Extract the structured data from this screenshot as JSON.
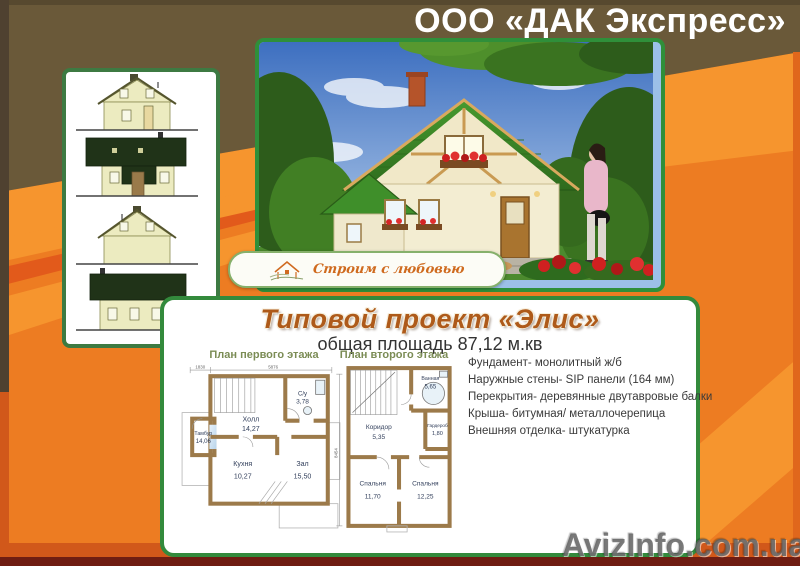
{
  "header": {
    "company": "ООО «ДАК Экспресс»"
  },
  "photo": {
    "slogan": "Строим с любовью"
  },
  "project": {
    "title": "Типовой проект «Элис»",
    "subtitle": "общая площадь 87,12 м.кв"
  },
  "plans": {
    "first": {
      "title": "План первого этажа",
      "dims": {
        "a": "1830",
        "b": "5876"
      },
      "rooms": [
        {
          "name": "Холл",
          "area": "14,27"
        },
        {
          "name": "С/у",
          "area": "3,78"
        },
        {
          "name": "Тамбур",
          "area": "14,06"
        },
        {
          "name": "Кухня",
          "area": "10,27"
        },
        {
          "name": "Зал",
          "area": "15,50"
        }
      ]
    },
    "second": {
      "title": "План второго этажа",
      "dims": {
        "v": "8454"
      },
      "rooms": [
        {
          "name": "Ванная",
          "area": "5,65"
        },
        {
          "name": "Коридор",
          "area": "5,35"
        },
        {
          "name": "Гардероб",
          "area": "1,80"
        },
        {
          "name": "Спальня",
          "area": "11,70"
        },
        {
          "name": "Спальня",
          "area": "12,25"
        }
      ]
    }
  },
  "specs": [
    "Фундамент- монолитный ж/б",
    "Наружные стены- SIP панели (164 мм)",
    "Перекрытия- деревянные двутавровые балки",
    "Крыша- битумная/ металлочерепица",
    "Внешняя отделка- штукатурка"
  ],
  "watermark": {
    "text": "AvizInfo.com.ua"
  },
  "colors": {
    "orange": "#ed7c22",
    "orange_light": "#f6952e",
    "stripe_red": "#e25a1b",
    "brown": "#6a5939",
    "green_frame": "#2f8f3a",
    "title_orange": "#ae5a1a",
    "maroon_strip": "#6f1d12"
  }
}
